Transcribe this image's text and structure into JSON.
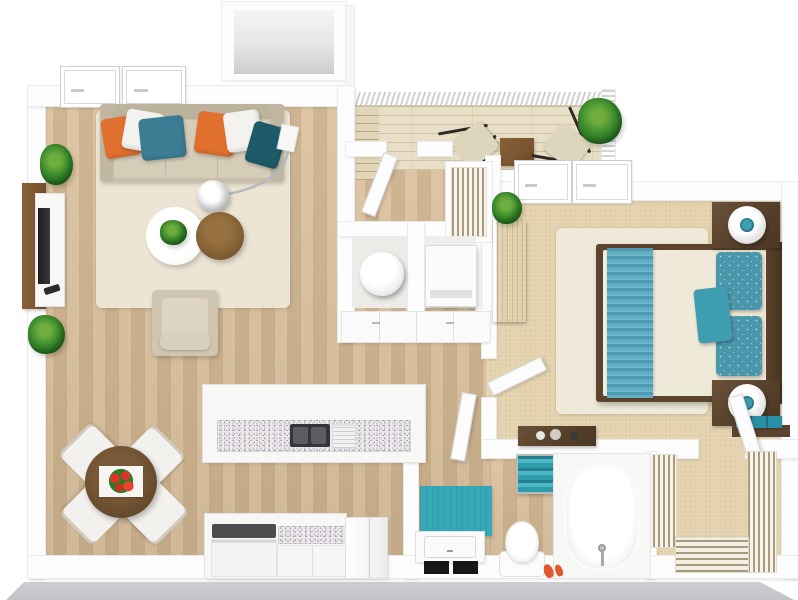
{
  "scene": {
    "type": "3d-rendered floor plan, top-down view",
    "unit": "one-bedroom one-bath apartment with balcony",
    "background": "#ffffff"
  },
  "palette": {
    "wood_floor": "#d8bd98",
    "deck_wood": "#e9dfc6",
    "bedroom_carpet": "#e3d2ad",
    "cream_rug": "#ece5d4",
    "wall_white": "#fdfdfd",
    "dark_wood": "#55402a",
    "mid_brown": "#8a6239",
    "sofa_beige": "#cdc3ae",
    "accent_orange": "#e2702f",
    "accent_teal": "#3c7d94",
    "accent_dark_teal": "#1d5b6b",
    "bright_teal": "#35a9b8",
    "bed_throw_teal": "#5fa8bd",
    "granite_speckle": "#8d8395",
    "shadow_gray": "#c6c6ca",
    "plant_green": "#3f8f2f",
    "flower_red": "#e03428"
  },
  "rooms": [
    {
      "name": "living-room",
      "furniture": [
        "sofa with 6 pillows (orange, white, teal, orange, white, dark-teal)",
        "arc floor lamp with chrome shade",
        "round white coffee table with plant",
        "round brown coffee table",
        "tv wall panel with media console and tv",
        "armchair",
        "2 potted plants",
        "cream area rug"
      ]
    },
    {
      "name": "dining-area",
      "furniture": [
        "round dark wood table",
        "white table runner with red flowers",
        "4 white chairs"
      ]
    },
    {
      "name": "kitchen",
      "furniture": [
        "peninsula bar with granite counter",
        "double sink",
        "dish rack",
        "range with black cooktop",
        "granite base counter",
        "refrigerator"
      ]
    },
    {
      "name": "balcony",
      "furniture": [
        "white railing",
        "2 butterfly chairs",
        "square wood side table",
        "potted plant",
        "entry stairs"
      ]
    },
    {
      "name": "entry-hall",
      "furniture": [
        "entry door",
        "louvered coat closet"
      ]
    },
    {
      "name": "utility-closets",
      "furniture": [
        "round water heater / washer",
        "square appliance",
        "white cabinet fronts"
      ]
    },
    {
      "name": "bedroom",
      "furniture": [
        "queen bed with cream duvet and teal striped throw",
        "teal patterned pillows",
        "teal accent pillow",
        "2 dark wood nightstands",
        "2 round white lamps with teal centers",
        "tall dresser with plant",
        "decor bench",
        "cream rug",
        "teal storage shelf",
        "2 windows to balcony"
      ]
    },
    {
      "name": "bathroom",
      "furniture": [
        "teal bath mat",
        "vanity with black drawers",
        "toilet",
        "chrome shelf with teal towels",
        "bathtub with faucet",
        "orange slippers"
      ]
    },
    {
      "name": "walk-in-closet",
      "furniture": [
        "wire shelving left",
        "wire shelving right",
        "wire shelving bottom",
        "closet door"
      ]
    }
  ]
}
